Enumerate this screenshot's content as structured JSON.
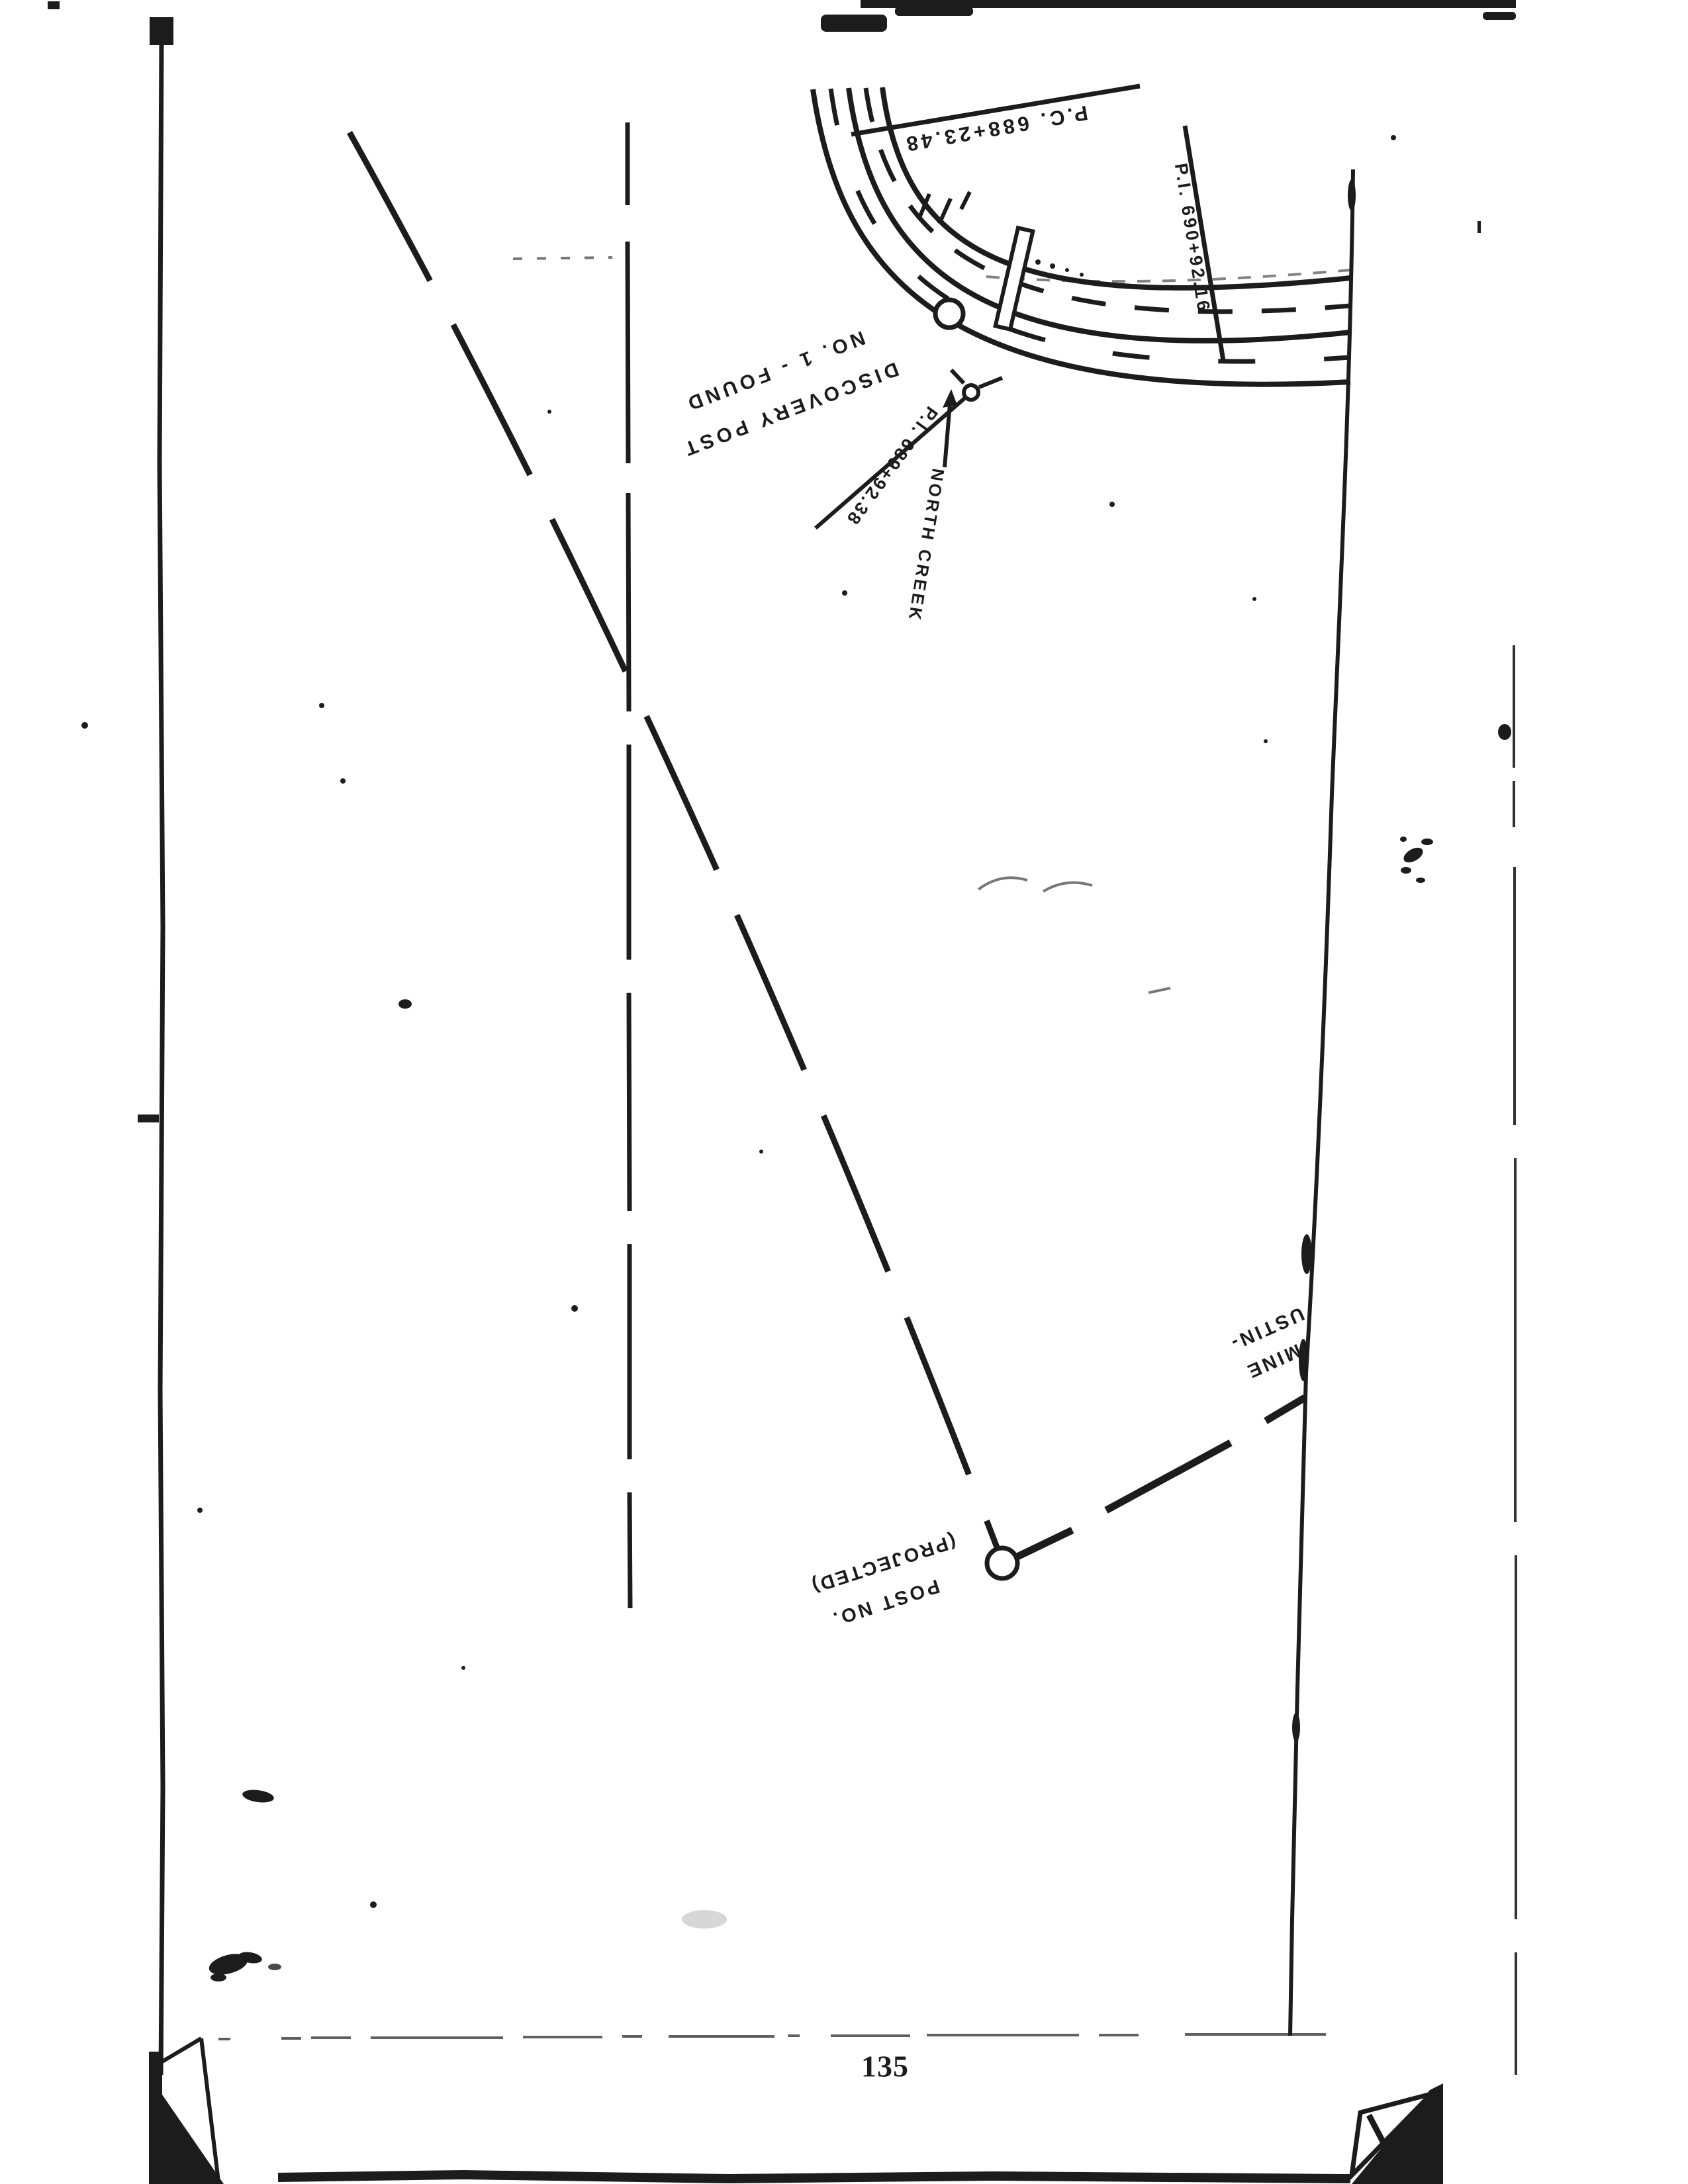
{
  "page": {
    "number": "135",
    "background_color": "#ffffff",
    "ink_color": "#1c1c1c"
  },
  "map": {
    "labels": {
      "discovery_post_line1": "DISCOVERY POST",
      "discovery_post_line2": "NO. 1 - FOUND",
      "pc_station": "P.C. 688+23.48",
      "pi_station_690": "P.I. 690+92.16",
      "pi_station_689": "P.I. 689+92.38",
      "north_creek": "NORTH CREEK",
      "mine_line1": "MINE",
      "mine_line2": "USTIN-",
      "projected_post_line1": "POST NO.",
      "projected_post_line2": "(PROJECTED)"
    },
    "symbols": {
      "discovery_post": "circle",
      "projected_post": "circle",
      "pi_point": "small-circle-with-ticks",
      "claim_post": "rectangle",
      "creek_direction": "arrow-up",
      "claim_boundary": "long-dashed-line",
      "road": "double-solid-curve-with-dashed-centerlines"
    }
  }
}
